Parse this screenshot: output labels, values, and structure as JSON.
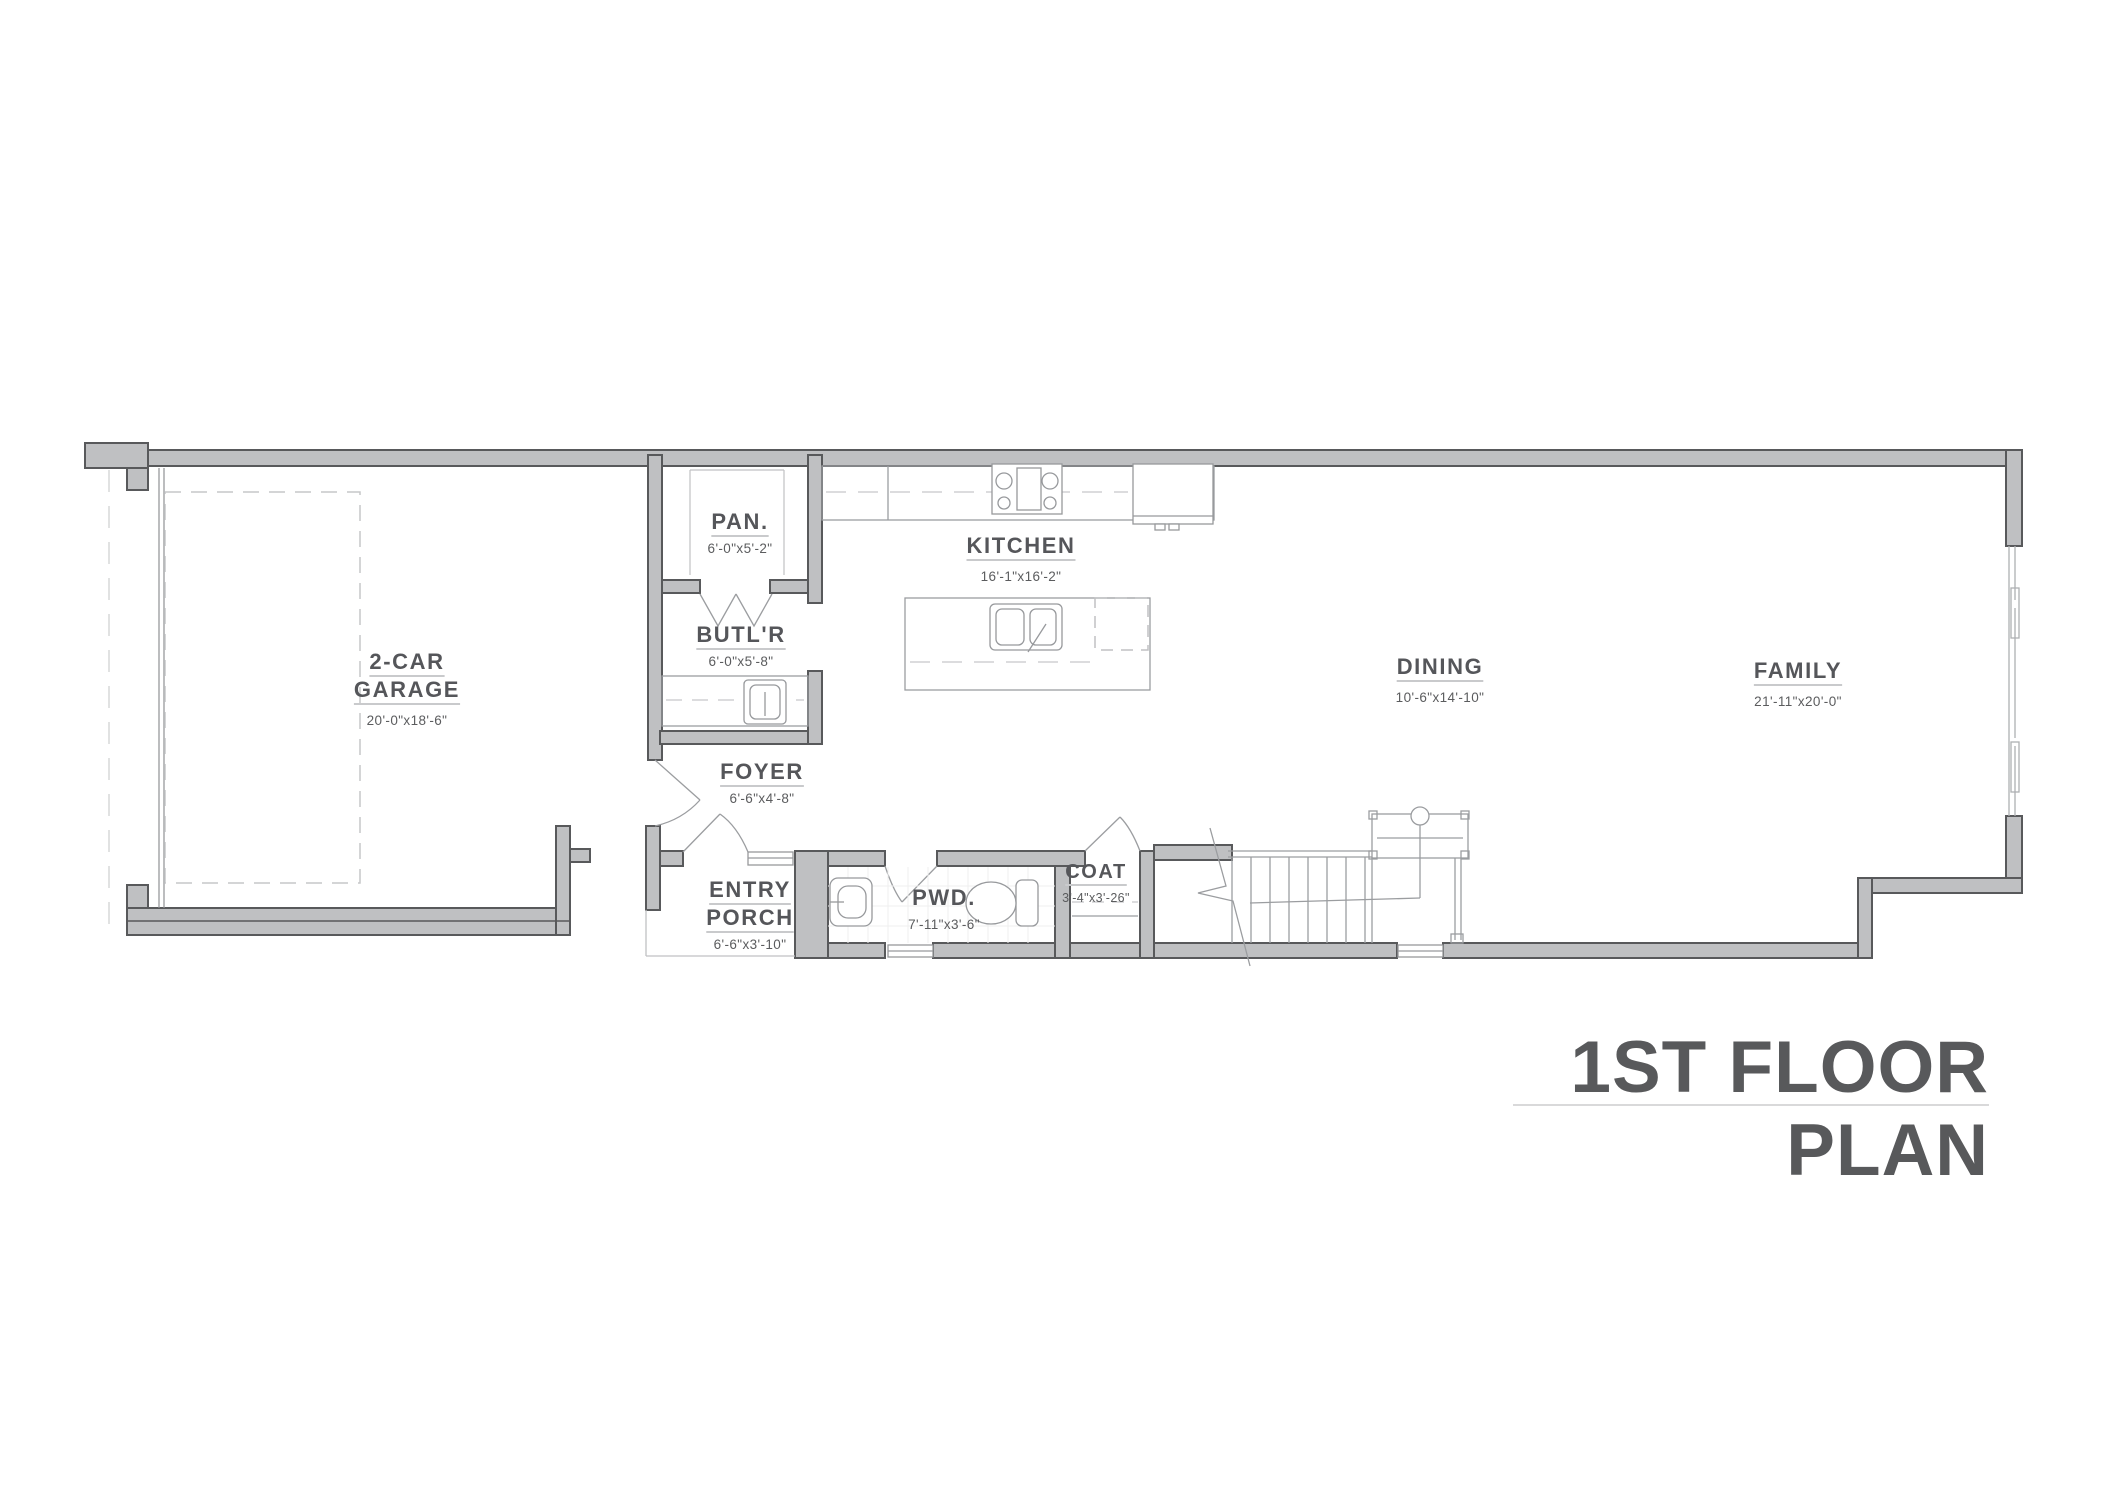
{
  "plan": {
    "title": "1ST FLOOR PLAN",
    "rooms": [
      {
        "id": "garage",
        "name": "2-CAR GARAGE",
        "dims": "20'-0\"x18'-6\""
      },
      {
        "id": "pantry",
        "name": "PAN.",
        "dims": "6'-0\"x5'-2\""
      },
      {
        "id": "butler",
        "name": "BUTL'R",
        "dims": "6'-0\"x5'-8\""
      },
      {
        "id": "kitchen",
        "name": "KITCHEN",
        "dims": "16'-1\"x16'-2\""
      },
      {
        "id": "dining",
        "name": "DINING",
        "dims": "10'-6\"x14'-10\""
      },
      {
        "id": "family",
        "name": "FAMILY",
        "dims": "21'-11\"x20'-0\""
      },
      {
        "id": "foyer",
        "name": "FOYER",
        "dims": "6'-6\"x4'-8\""
      },
      {
        "id": "entry-porch",
        "name": "ENTRY PORCH",
        "dims": "6'-6\"x3'-10\""
      },
      {
        "id": "powder",
        "name": "PWD.",
        "dims": "7'-11\"x3'-6\""
      },
      {
        "id": "coat",
        "name": "COAT",
        "dims": "3'-4\"x3'-26\""
      }
    ],
    "colors": {
      "wall_fill": "#bfc0c2",
      "wall_stroke": "#58595b",
      "fixture_line": "#97999c",
      "dashed_line": "#c6c7c9",
      "text": "#55565a",
      "underline": "#c9cacc"
    }
  }
}
